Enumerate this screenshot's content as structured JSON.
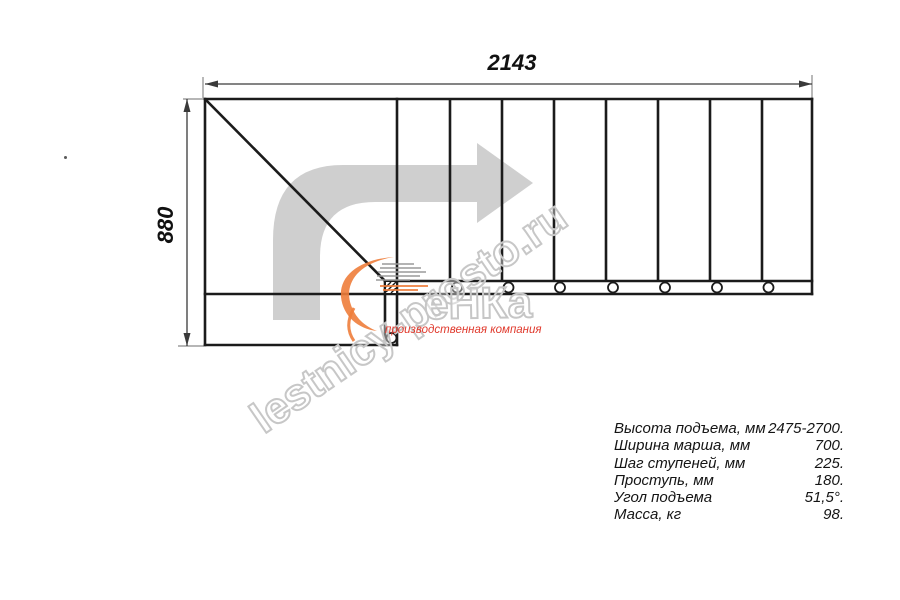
{
  "page": {
    "background": "#ffffff"
  },
  "drawing": {
    "type": "staircase-plan-top-view",
    "width_label": "2143",
    "height_label": "880",
    "line_color": "#1b1b1b",
    "dimension_color": "#3a3a3a",
    "direction_arrow_color": "#cfcfcf",
    "straight_steps": 8,
    "baluster_circles": 8
  },
  "watermark": {
    "text": "lestnicy-prosto.ru",
    "color": "#c7c7c7"
  },
  "logo": {
    "text": "еНКа",
    "subtitle": "производственная компания",
    "text_color": "#c6c6c6",
    "subtitle_color": "#e0392c",
    "swoosh_color": "#ee7d3b"
  },
  "specs": {
    "rows": [
      {
        "label": "Высота подъема, мм",
        "value": "2475-2700."
      },
      {
        "label": "Ширина марша, мм",
        "value": "700."
      },
      {
        "label": "Шаг ступеней, мм",
        "value": "225."
      },
      {
        "label": "Проступь, мм",
        "value": "180."
      },
      {
        "label": "Угол подъема",
        "value": "51,5°."
      },
      {
        "label": "Масса, кг",
        "value": "98."
      }
    ]
  }
}
